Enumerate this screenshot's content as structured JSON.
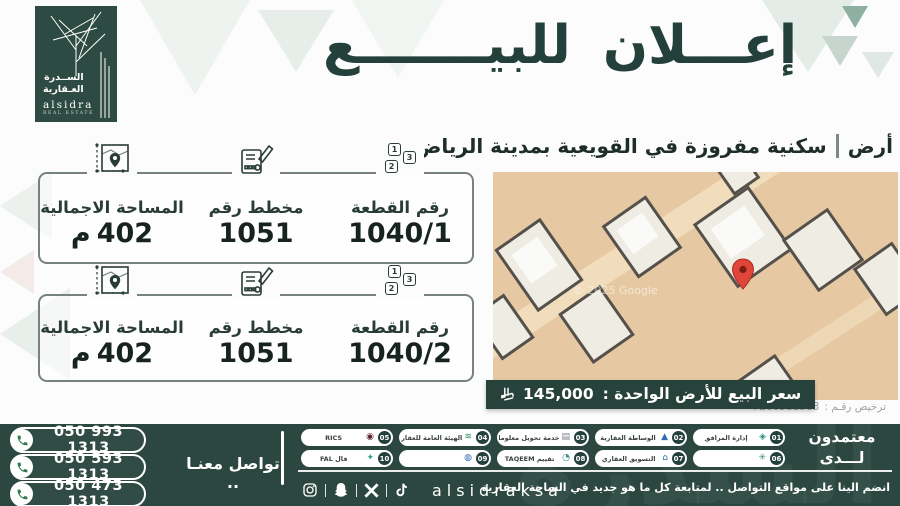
{
  "brand": {
    "name_line1": "الســدرة",
    "name_line2": "العـقارية",
    "name_en": "alsidra",
    "tagline_en": "REAL ESTATE",
    "watermark": "السدرة"
  },
  "title": {
    "word1": "إعـــلان",
    "word2": "للبيـــــــع"
  },
  "subtitle": {
    "prefix": "أرض",
    "text": "سكنية مفروزة في القويعية بمدينة الرياض"
  },
  "icons": {
    "plot_numbers": [
      "1",
      "2",
      "3"
    ]
  },
  "cards": [
    {
      "plot_label": "رقم القطعة",
      "plot_value": "1040/1",
      "plan_label": "مخطط رقم",
      "plan_value": "1051",
      "area_label": "المساحة الاجمالية",
      "area_value": "402",
      "area_unit": "م"
    },
    {
      "plot_label": "رقم القطعة",
      "plot_value": "1040/2",
      "plan_label": "مخطط رقم",
      "plan_value": "1051",
      "area_label": "المساحة الاجمالية",
      "area_value": "402",
      "area_unit": "م"
    }
  ],
  "price": {
    "label": "سعر البيع للأرض الواحدة :",
    "value": "145,000"
  },
  "license": {
    "label": "ترخيص رقـم :",
    "value": "7200581963"
  },
  "map": {
    "watermark": "© 2025 Google"
  },
  "footer": {
    "contact_label": "تواصل معنـا ..",
    "phones": [
      "050 993 1313",
      "050 593 1313",
      "050 473 1313"
    ],
    "accredited_line1": "معتمدون",
    "accredited_line2": "لـــدى",
    "badges": [
      {
        "num": "01",
        "label": "إدارة المرافق"
      },
      {
        "num": "02",
        "label": "الوساطة العقارية"
      },
      {
        "num": "03",
        "label": "خدمة تحويل معلومات سكني"
      },
      {
        "num": "04",
        "label": "الهيئة العامة للعقار"
      },
      {
        "num": "05",
        "label": "RICS"
      },
      {
        "num": "06",
        "label": ""
      },
      {
        "num": "07",
        "label": "التسويق العقاري"
      },
      {
        "num": "08",
        "label": "تقييم TAQEEM"
      },
      {
        "num": "09",
        "label": ""
      },
      {
        "num": "10",
        "label": "فال FAL"
      }
    ],
    "social_handle": "alsidraksa",
    "social_note": "انضم الينا على مواقع التواصل .. لمتابعة كل ما هو جديد في الساحة العقارية"
  }
}
